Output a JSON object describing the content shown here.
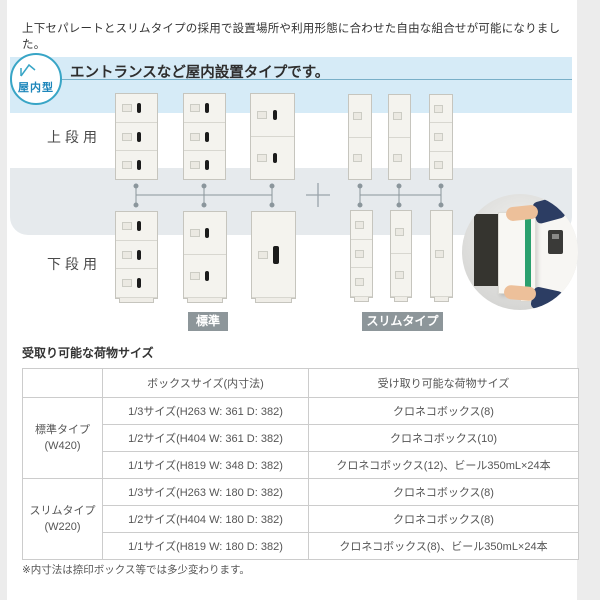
{
  "intro": "上下セパレートとスリムタイプの採用で設置場所や利用形態に合わせた自由な組合せが可能になりました。",
  "indoor": {
    "badge_label": "屋内型",
    "title": "エントランスなど屋内設置タイプです。",
    "upper_row_label": "上段用",
    "lower_row_label": "下段用",
    "standard_label": "標準",
    "slim_label": "スリムタイプ"
  },
  "colors": {
    "accent_teal": "#38a5c6",
    "panel_blue": "#d6ebf7",
    "band_gray": "#e6eaed",
    "type_badge_gray": "#8d969a",
    "connector_gray": "#8b969c",
    "package_stripe_green": "#2aa06e"
  },
  "cargo": {
    "title": "受取り可能な荷物サイズ",
    "headers": {
      "col1": "",
      "col2": "ボックスサイズ(内寸法)",
      "col3": "受け取り可能な荷物サイズ"
    },
    "groups": [
      {
        "name": "標準タイプ",
        "width_note": "(W420)",
        "rows": [
          {
            "box": "1/3サイズ(H263 W: 361 D: 382)",
            "cargo": "クロネコボックス(8)"
          },
          {
            "box": "1/2サイズ(H404 W: 361 D: 382)",
            "cargo": "クロネコボックス(10)"
          },
          {
            "box": "1/1サイズ(H819 W: 348 D: 382)",
            "cargo": "クロネコボックス(12)、ビール350mL×24本"
          }
        ]
      },
      {
        "name": "スリムタイプ",
        "width_note": "(W220)",
        "rows": [
          {
            "box": "1/3サイズ(H263 W: 180 D: 382)",
            "cargo": "クロネコボックス(8)"
          },
          {
            "box": "1/2サイズ(H404 W: 180 D: 382)",
            "cargo": "クロネコボックス(8)"
          },
          {
            "box": "1/1サイズ(H819 W: 180 D: 382)",
            "cargo": "クロネコボックス(8)、ビール350mL×24本"
          }
        ]
      }
    ],
    "note": "※内寸法は捺印ボックス等では多少変わります。"
  }
}
